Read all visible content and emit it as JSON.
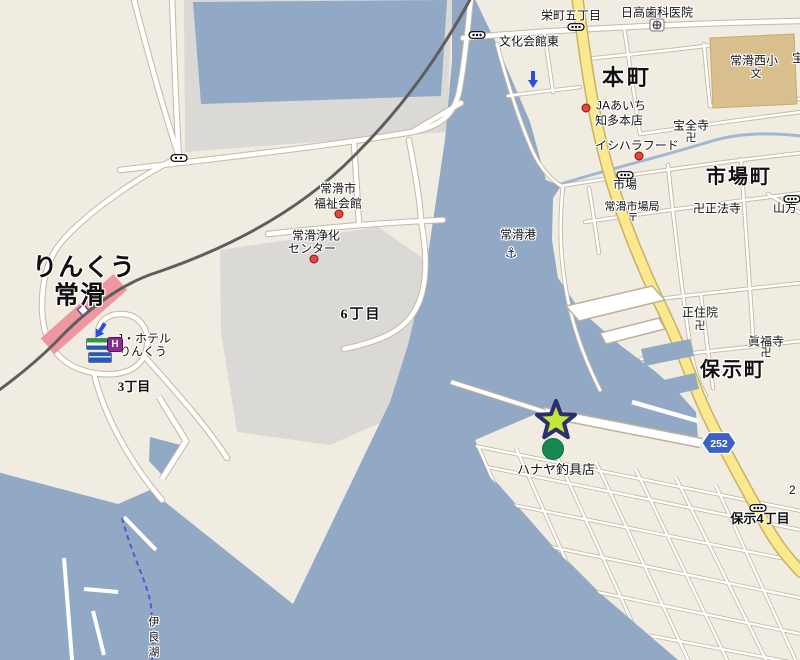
{
  "map_title": "Tokoname harbor area web map",
  "colors": {
    "land": "#F1ECE1",
    "water": "#91A9C5",
    "pier_gray": "#DBD9D6",
    "road_fill": "#FFFFFF",
    "road_casing": "#C3B9A4",
    "yellow_road": "#FAE98E",
    "yellow_casing": "#C9B163",
    "railway": "#5E5E5E",
    "station_pink": "#EF97A1",
    "school_tan": "#D9BE8E",
    "star_fill": "#C3E63A",
    "star_border": "#2A2F6E",
    "poi_green": "#17894F",
    "poi_red": "#E8453C",
    "route_badge_blue": "#3B62C4",
    "ferry_dash": "#5B55CC",
    "stream": "#9FB9D2"
  },
  "labels": {
    "sakaemachi_5chome": "栄町五丁目",
    "hidaka_dental": "日高歯科医院",
    "bunka_kaikan_higashi": "文化会館東",
    "honmachi": "本町",
    "ja_aichi_1": "JAあいち",
    "ja_aichi_2": "知多本店",
    "takara_partial": "宝",
    "tokoname_nishi_elem": "常滑西小",
    "school_glyph": "文",
    "hozenji": "宝全寺",
    "ishihara_food": "イシハラフード",
    "ichibacho": "市場町",
    "ichiba": "市場",
    "tokoname_ichiba_post": "常滑市場局",
    "post_glyph": "〒",
    "shohoji": "卍正法寺",
    "yamakata": "山方",
    "fukushi_1": "常滑市",
    "fukushi_2": "福祉会館",
    "jouka_1": "常滑浄化",
    "jouka_2": "センター",
    "tokoname_port": "常滑港",
    "anchor_glyph": "⚓",
    "chome6": "6丁目",
    "rinku_1": "りんくう",
    "rinku_2": "常滑",
    "jhotel_1": "J・ホテル",
    "jhotel_2": "りんくう",
    "hotel_h": "H",
    "chome3": "3丁目",
    "shojuin": "正住院",
    "manji_glyph": "卍",
    "shinpukuji": "眞福寺",
    "hojimachi": "保示町",
    "hanaya": "ハナヤ釣具店",
    "hoji_4chome": "保示4丁目",
    "irako": "伊良湖",
    "partial_2": "2"
  },
  "route_badge": {
    "number": "252"
  },
  "markers": {
    "star": "selected-location-star",
    "green_circle": "poi-hanaya-tackle-shop",
    "anchor": "port-anchor-symbol",
    "bus_stops": [
      "栄町五丁目",
      "文化会館東",
      "市場",
      "山方",
      "保示4丁目"
    ]
  }
}
